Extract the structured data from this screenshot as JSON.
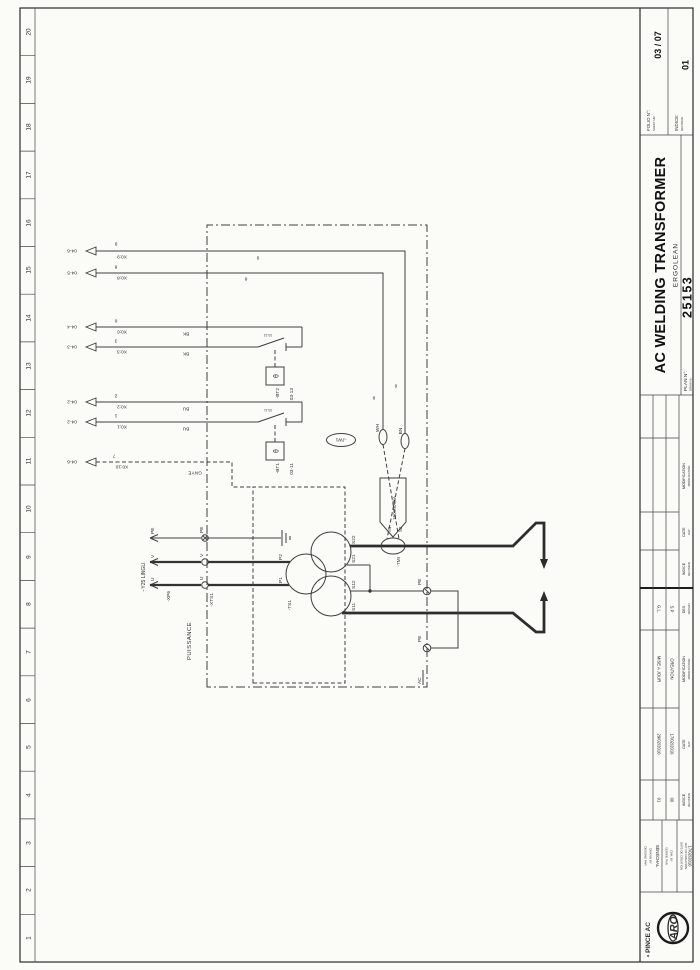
{
  "sheet": {
    "ruler_numbers": [
      "1",
      "2",
      "3",
      "4",
      "5",
      "6",
      "7",
      "8",
      "9",
      "10",
      "11",
      "12",
      "13",
      "14",
      "15",
      "16",
      "17",
      "18",
      "19",
      "20"
    ]
  },
  "schematic": {
    "terminals": [
      {
        "ref": "04-6",
        "name": "X0:10",
        "wire": "7",
        "color": "GNYE"
      },
      {
        "ref": "04-2",
        "name": "X0:1",
        "wire": "1",
        "color": "BU"
      },
      {
        "ref": "04-2",
        "name": "X0:2",
        "wire": "2",
        "color": "BU"
      },
      {
        "ref": "04-3",
        "name": "X0:3",
        "wire": "3",
        "color": "BK"
      },
      {
        "ref": "04-4",
        "name": "X0:6",
        "wire": "6",
        "color": "BK"
      },
      {
        "ref": "04-5",
        "name": "X0:8",
        "wire": "8"
      },
      {
        "ref": "04-6",
        "name": "X0:9",
        "wire": "9"
      }
    ],
    "connector_xp6": {
      "label": "-XP6",
      "pin_u": "U",
      "pin_v": "V",
      "pin_pe": "PE"
    },
    "connector_xts1": {
      "label": "-XTS1",
      "pin_u": "U",
      "pin_v": "V",
      "pin_pe": "PE"
    },
    "cable_label": "- Y25 LINGLI",
    "power_label": "PUISSANCE",
    "transformer": {
      "label": "-TS1",
      "p1": "P1",
      "p2": "P2",
      "s11": "S11",
      "s12": "S12",
      "s21": "S21",
      "s22": "S22"
    },
    "thermal_bt1": {
      "label": "-BT1",
      "ref": "03-11",
      "symbol": "θ",
      "contact_ref": "03-11"
    },
    "thermal_bt2": {
      "label": "-BT2",
      "ref": "03-13",
      "symbol": "θ",
      "contact_ref": "03-13"
    },
    "sensor_tmi": {
      "label": "-TMI",
      "s1": "S1",
      "s2": "S2",
      "rating": "150mVA/kA"
    },
    "jumper_jw1": {
      "label": "-JW1"
    },
    "wire_colors": {
      "gnye": "GNYE",
      "wh": "WH",
      "bn": "BN"
    },
    "wire_numbers": {
      "w8": "8",
      "w9": "9"
    },
    "pe_label": "PE",
    "ac_label": "AC"
  },
  "title_block": {
    "doc_title": "• PINCE AC",
    "logo_text": "ARO",
    "drawn_label": "DESSINE PAR",
    "drawn_label_en": "DRAWN BY",
    "drawn_by": "SÉNÉCHAL",
    "checked_label": "VERIFIE PAR",
    "checked_label_en": "CHK. BY",
    "created_label": "DATE DE CREATION",
    "created_label_en": "DAY OF CREATION",
    "created_date": "17/02/2010",
    "revisions": [
      {
        "indice": "01",
        "date": "29/02/2010",
        "modification": "MISE A JOUR",
        "by": "G.L."
      },
      {
        "indice": "00",
        "date": "17/02/2010",
        "modification": "CREATION",
        "by": "S.P"
      }
    ],
    "rev_headers": {
      "indice": "INDICE",
      "indice_sub": "REVISION",
      "date": "DATE",
      "date_sub": "DAY",
      "modification": "MODIFICATION",
      "modification_sub": "MODIFICATION",
      "des": "DES.",
      "des_sub": "DRAWN"
    },
    "title": "AC WELDING TRANSFORMER",
    "subtitle": "ERGOLEAN",
    "plan_label": "PLAN N°:",
    "plan_label_en": "DRAW Nr:",
    "plan_no": "25153",
    "folio_label": "FOLIO N°:",
    "folio_label_en": "SHEET NR:",
    "folio": "03 / 07",
    "indice_label": "INDICE:",
    "indice_label_en": "REVISION",
    "indice": "01"
  }
}
